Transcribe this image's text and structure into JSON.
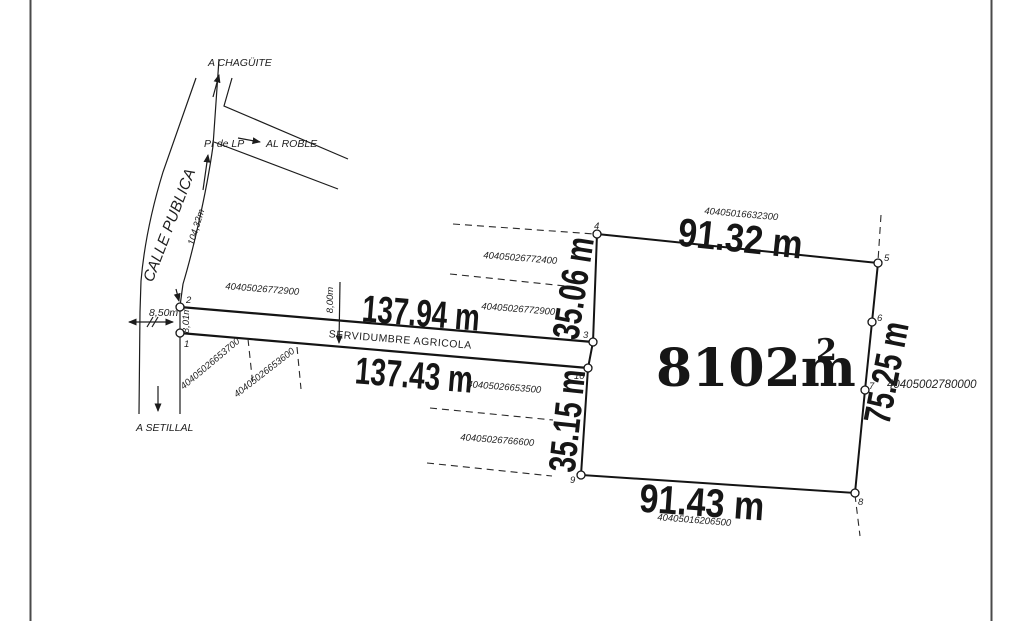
{
  "drawing": {
    "area": {
      "value": "8102m",
      "sup": "2"
    },
    "dims": {
      "top": "91.32 m",
      "right": "75.25 m",
      "bottom": "91.43 m",
      "west_upper": "35.06 m",
      "west_lower": "35.15 m",
      "strip_top": "137.94 m",
      "strip_bottom": "137.43 m",
      "road_width": "8,50m",
      "strip_width_west": "8,01m",
      "strip_width_mid": "8,00m",
      "road_length": "104,32m"
    },
    "labels": {
      "road": "CALLE PUBLICA",
      "strip": "SERVIDUMBRE AGRICOLA",
      "north_destination": "A CHAGÜITE",
      "east_destination": "AL ROBLE",
      "south_destination": "A SETILLAL",
      "pi_marker": "PI de LP"
    },
    "cadastral": {
      "north": "40405016632300",
      "west_upper_1": "40405026772400",
      "west_upper_2": "40405026772900",
      "strip_north": "40405026772900",
      "strip_south": "40405026653500",
      "west_lower": "40405026766600",
      "south": "40405016206500",
      "east": "40405002780000",
      "diag_a": "40405026653700",
      "diag_b": "40405026653600"
    },
    "points": {
      "p1": "1",
      "p2": "2",
      "p3": "3",
      "p4": "4",
      "p5": "5",
      "p6": "6",
      "p7": "7",
      "p8": "8",
      "p9": "9",
      "p10": "10"
    }
  },
  "colors": {
    "line": "#1c1c1c",
    "frame": "#4a4a4a",
    "text": "#161616",
    "background": "#ffffff"
  }
}
